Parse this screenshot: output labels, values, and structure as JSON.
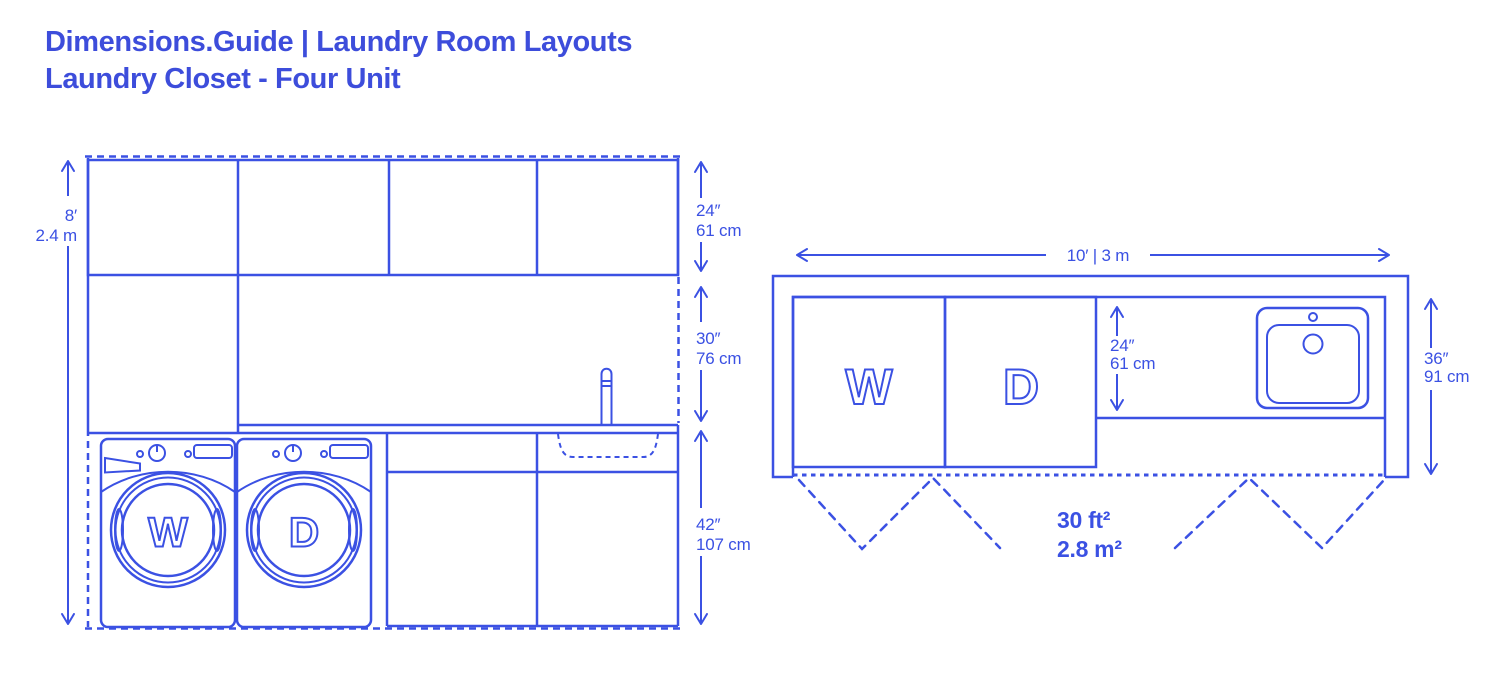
{
  "colors": {
    "accent": "#3B51E3",
    "title": "#3D4DDB",
    "background": "#FFFFFF"
  },
  "header": {
    "line1": "Dimensions.Guide | Laundry Room Layouts",
    "line2": "Laundry Closet - Four Unit"
  },
  "elevation": {
    "washer_letter": "W",
    "dryer_letter": "D",
    "height_dim": {
      "primary": "8′",
      "secondary": "2.4 m"
    },
    "upper_cabinet_dim": {
      "primary": "24″",
      "secondary": "61 cm"
    },
    "backsplash_dim": {
      "primary": "30″",
      "secondary": "76 cm"
    },
    "base_cabinet_dim": {
      "primary": "42″",
      "secondary": "107 cm"
    }
  },
  "plan": {
    "washer_letter": "W",
    "dryer_letter": "D",
    "width_dim": "10′ | 3 m",
    "counter_depth_dim": {
      "primary": "24″",
      "secondary": "61 cm"
    },
    "room_depth_dim": {
      "primary": "36″",
      "secondary": "91 cm"
    },
    "area": {
      "imperial": "30 ft²",
      "metric": "2.8 m²"
    }
  }
}
